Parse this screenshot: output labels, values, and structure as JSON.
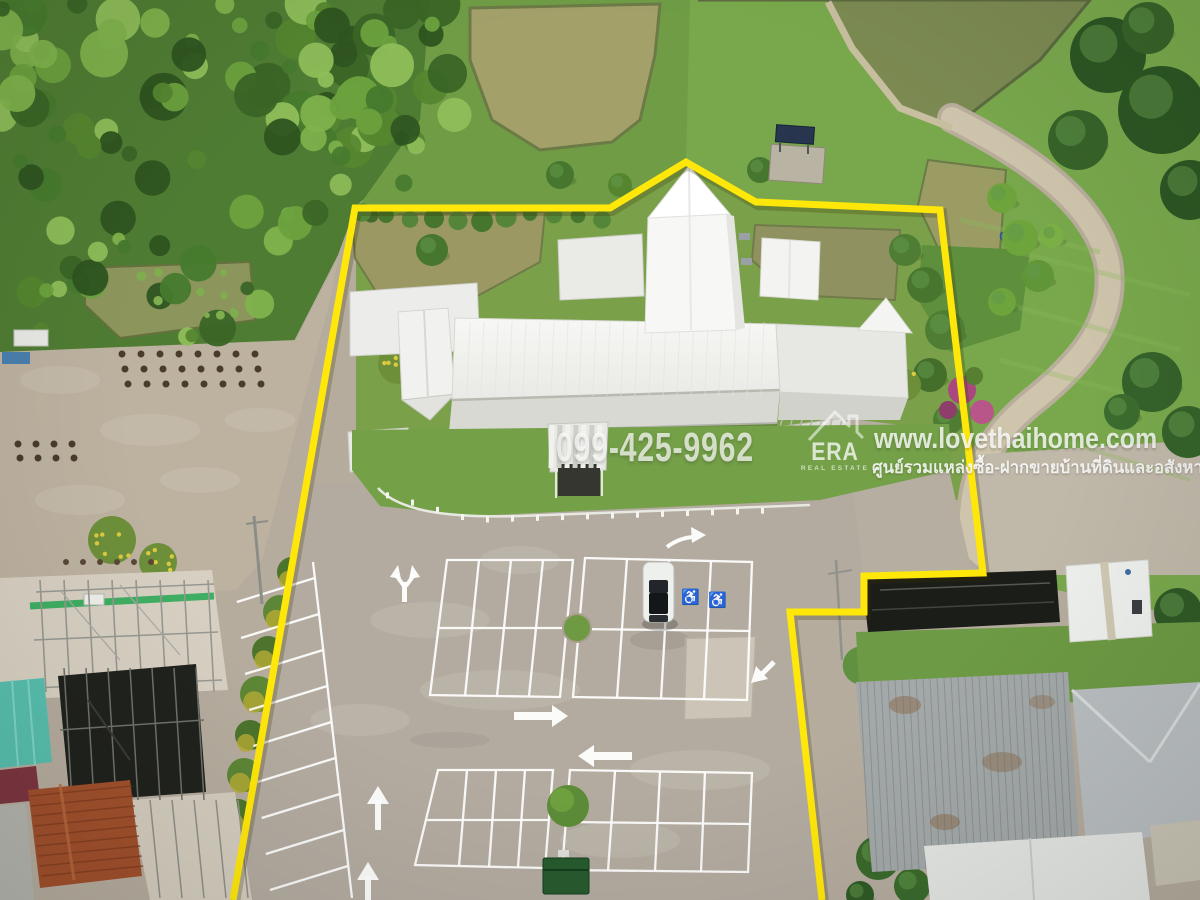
{
  "image": {
    "type": "aerial-drone-photo",
    "subject": "White-roofed single-storey building complex with large striped parking lot, fish ponds and tropical farmland; property boundary outlined in yellow"
  },
  "watermark": {
    "phone": "099-425-9962",
    "website": "www.lovethaihome.com",
    "tagline_th": "ศูนย์รวมแหล่งซื้อ-ฝากขายบ้านที่ดินและอสังหาริมทรัพย์",
    "agency": {
      "name": "ERA",
      "subtitle": "REAL ESTATE"
    }
  },
  "overlay": {
    "boundary_color": "#ffe70a",
    "watermark_color": "#ffffff",
    "boundary_points": "233,900 355,208 610,208 686,162 756,202 940,210 983,573 864,576 864,612 790,612 822,900"
  },
  "markings": {
    "disabled_symbol": "♿"
  }
}
